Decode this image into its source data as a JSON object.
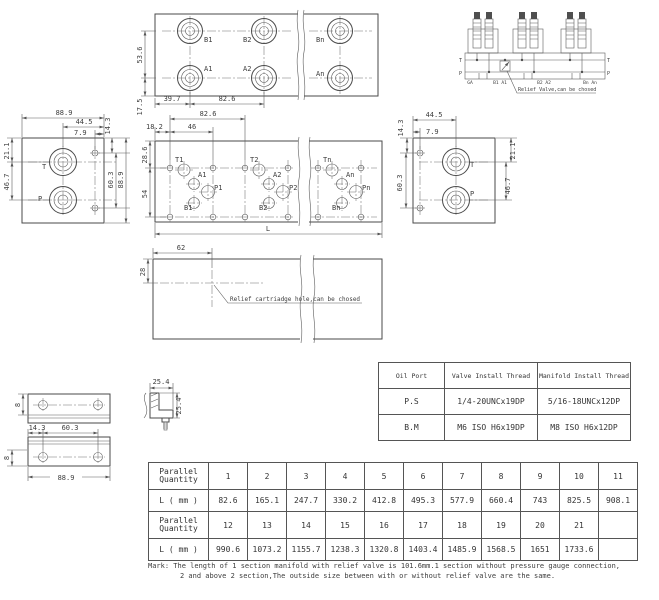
{
  "top_view": {
    "dims": {
      "v1": "53.6",
      "v2": "17.5",
      "h1": "39.7",
      "h2": "82.6"
    },
    "ports": {
      "b1": "B1",
      "b2": "B2",
      "bn": "Bn",
      "a1": "A1",
      "a2": "A2",
      "an": "An"
    }
  },
  "schematic": {
    "t_left": "T",
    "p_left": "P",
    "t_right": "T",
    "p_right": "P",
    "ga": "GA",
    "b1a1": "B1 A1",
    "b2a2": "B2 A2",
    "bnan": "Bn An",
    "note": "Relief Valve,can be chosed"
  },
  "left_view": {
    "dims": {
      "top1": "88.9",
      "top2": "44.5",
      "top3": "7.9",
      "rt": "14.3",
      "left1": "21.1",
      "left2": "46.7",
      "right1": "60.3",
      "right2": "88.9"
    },
    "t": "T",
    "p": "P"
  },
  "main_view": {
    "dims": {
      "top1": "82.6",
      "top2": "18.2",
      "top3": "46",
      "left1": "28.6",
      "left2": "54",
      "bottom": "L"
    },
    "s1": {
      "t": "T1",
      "a": "A1",
      "p": "P1",
      "b": "B1"
    },
    "s2": {
      "t": "T2",
      "a": "A2",
      "p": "P2",
      "b": "B2"
    },
    "s3": {
      "t": "Tn",
      "a": "An",
      "p": "Pn",
      "b": "Bn"
    }
  },
  "right_view": {
    "dims": {
      "top1": "44.5",
      "top2": "7.9",
      "left1": "14.3",
      "left2": "60.3",
      "right1": "21.1",
      "right2": "46.7"
    },
    "t": "T",
    "p": "P"
  },
  "section_view": {
    "dims": {
      "h": "62",
      "v": "28"
    },
    "note": "Relief cartriadge hole,can be chosed"
  },
  "brackets": {
    "dim_8_top": "8",
    "dim_25_4_h": "25.4",
    "dim_25_4_v": "25.4",
    "dim_14_3": "14.3",
    "dim_60_3": "60.3",
    "dim_8_bottom": "8",
    "dim_88_9": "88.9"
  },
  "oil_port_table": {
    "headers": [
      "Oil Port",
      "Valve Install Thread",
      "Manifold Install Thread"
    ],
    "rows": [
      {
        "port": "P.S",
        "valve": "1/4-20UNCx19DP",
        "manifold": "5/16-18UNCx12DP"
      },
      {
        "port": "B.M",
        "valve": "M6 ISO H6x19DP",
        "manifold": "M8 ISO H6x12DP"
      }
    ]
  },
  "length_table": {
    "qty_label": "Parallel\nQuantity",
    "l_label": "L ( mm )",
    "row1": [
      "1",
      "2",
      "3",
      "4",
      "5",
      "6",
      "7",
      "8",
      "9",
      "10",
      "11"
    ],
    "row2": [
      "82.6",
      "165.1",
      "247.7",
      "330.2",
      "412.8",
      "495.3",
      "577.9",
      "660.4",
      "743",
      "825.5",
      "908.1"
    ],
    "row3": [
      "12",
      "13",
      "14",
      "15",
      "16",
      "17",
      "18",
      "19",
      "20",
      "21",
      ""
    ],
    "row4": [
      "990.6",
      "1073.2",
      "1155.7",
      "1238.3",
      "1320.8",
      "1403.4",
      "1485.9",
      "1568.5",
      "1651",
      "1733.6",
      ""
    ]
  },
  "mark": {
    "line1": "Mark: The length of 1 section manifold with relief valve is 101.6mm.1 section without pressure gauge connection,",
    "line2": "2 and above 2 section,The outside size between with or without relief valve are the same."
  }
}
